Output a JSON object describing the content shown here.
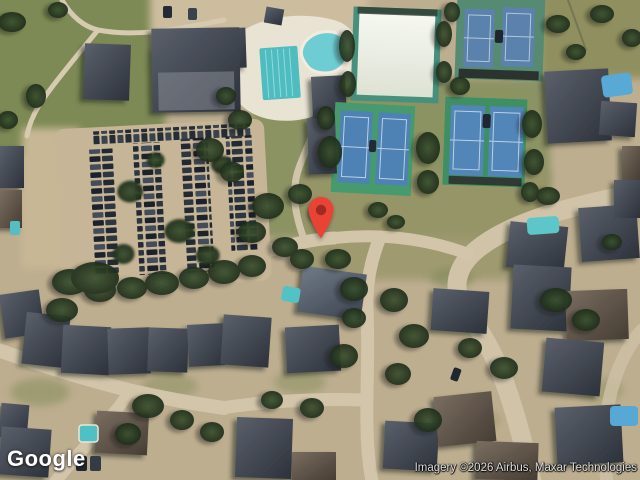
{
  "overlay": {
    "logo": "Google",
    "attribution": "Imagery ©2026 Airbus, Maxar Technologies"
  },
  "marker": {
    "color": "#EA4335",
    "dot_color": "#9E2B20"
  },
  "colors": {
    "tennis_court_blue": "#5b82ac",
    "tennis_surround_green": "#3f8f64",
    "pool_teal": "#52c2c4",
    "road_tan": "#d2c5aa",
    "tree_green": "#2c3b27",
    "roof_gray": "#3f444e",
    "grass_olive": "#7f8a57",
    "dome_white": "#eef0e8"
  }
}
